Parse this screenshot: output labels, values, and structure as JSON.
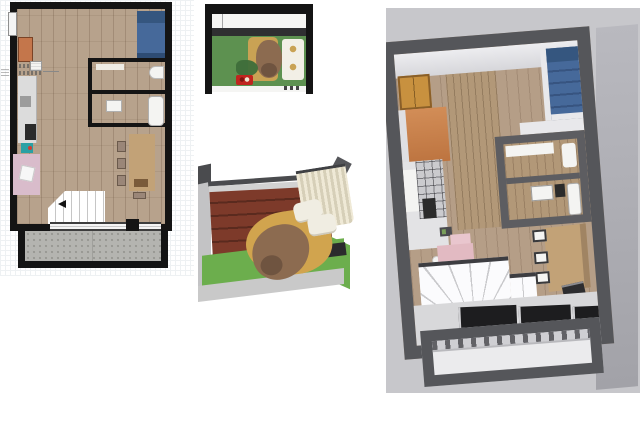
{
  "page": {
    "title": "Interior design project — plan and 3D views",
    "background": "#ffffff"
  },
  "views": {
    "floor_plan": {
      "name": "2D floor plan — studio apartment with balcony"
    },
    "pet_plan": {
      "name": "Plan detail — pet terrace top view"
    },
    "terrace_render": {
      "name": "3D render — pet terrace with dog bed and curtain"
    },
    "overview_render": {
      "name": "3D render — apartment overview from above"
    }
  },
  "palette": {
    "wall_black": "#141414",
    "wood_floor": "#b7a28c",
    "grid_line": "#eef1f3",
    "window_white": "#f4f4f4",
    "bed_blue": "#46699a",
    "bed_pillow_blue": "#35567f",
    "bed_foot_blue": "#2e4c74",
    "cabinet_orange": "#c4764b",
    "kitchen_gray": "#dcdcdc",
    "kitchen_mid_gray": "#9c9c9c",
    "appliance_dark": "#2b2b2b",
    "teal_item": "#2aa0a4",
    "desk_pink": "#d9bccb",
    "chair_white": "#f7f7f7",
    "fixture_white": "#f4f4f2",
    "shelf_white": "#efece5",
    "table_tan": "#c2a277",
    "chair_wood": "#9a8678",
    "door_black": "#141414",
    "concrete": "#b4b4b0",
    "pet_white_band": "#f5f5f3",
    "pet_dark_band": "#2f2f31",
    "pet_green": "#5d9150",
    "dog_brown": "#8c6b50",
    "dog_bed_tan": "#c9a254",
    "bedding_white": "#f2efe6",
    "plant_green": "#3e6e3a",
    "bowl_red": "#c0251f",
    "terrace_wall_gray": "#c3c3c5",
    "terrace_beam_dark": "#4a4b4e",
    "terrace_back_gray": "#d2d2d2",
    "bench_brown": "#7d3a2a",
    "curtain_cream": "#e9e4d2",
    "terrace_green": "#6cae4d",
    "terrace_slab": "#c9c9c9",
    "blanket_gold": "#d1a44e",
    "bed_base_dark": "#2b2b2d",
    "pillow_white": "#f0ede2",
    "render_bg": "#c7c7cb",
    "render_wall_dark": "#55565a",
    "render_wall_face": "#b2b2b8",
    "render_ceiling": "#ededf0",
    "render_wood": "#b59e87",
    "render_midwall_wood": "#b29878",
    "render_cabinet_wood": "#c8913f",
    "render_orange_wall": "#cc8450",
    "render_white_cap": "#dfdfe2",
    "render_white": "#e8e8eb",
    "render_kitchen_white": "#e3e3e5",
    "render_tile_gray": "#cbcbce",
    "render_pink": "#e2bac2",
    "render_pink_light": "#e9c6ce",
    "stair_white": "#fbfbfd",
    "panel_black": "#1d1d1f",
    "walkway_gray": "#d8d8da",
    "balcony_inner": "#ebebed",
    "balcony_band": "#cfcfd3",
    "art_dark": "#4a4a4e",
    "laptop_dark": "#2d2d2f"
  }
}
